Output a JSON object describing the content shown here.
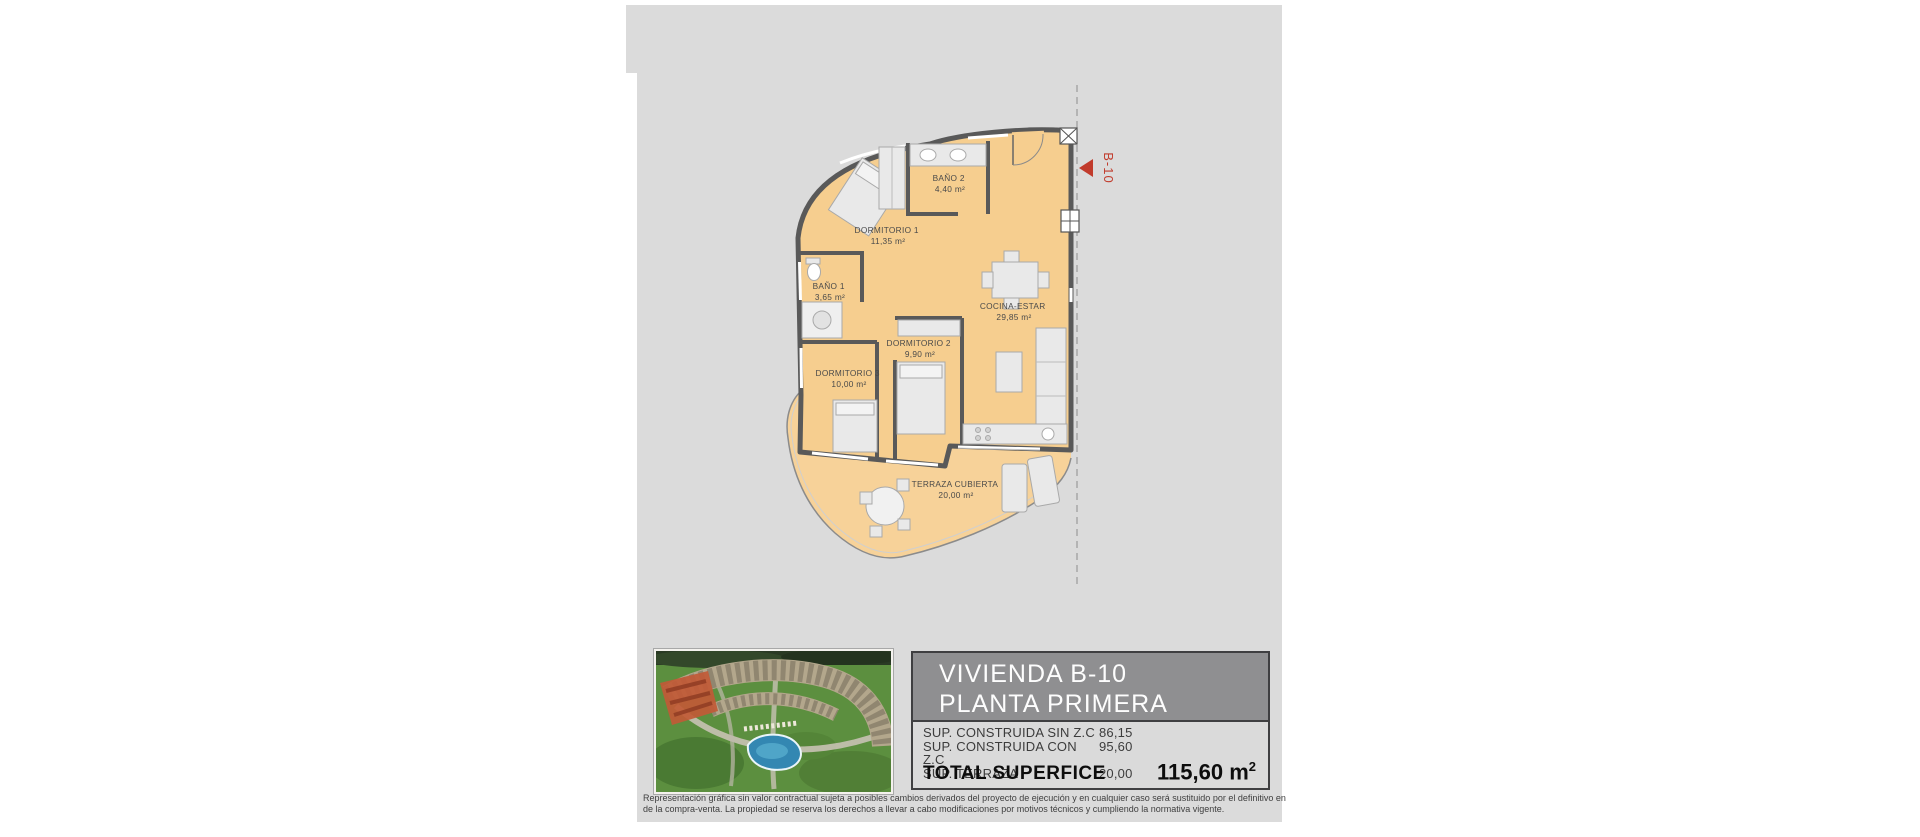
{
  "plan": {
    "marker_label": "B-10",
    "rooms": [
      {
        "name": "DORMITORIO 1",
        "area": "11,35 m²"
      },
      {
        "name": "BAÑO 2",
        "area": "4,40 m²"
      },
      {
        "name": "COCINA-ESTAR",
        "area": "29,85 m²"
      },
      {
        "name": "BAÑO 1",
        "area": "3,65 m²"
      },
      {
        "name": "DORMITORIO 2",
        "area": "9,90 m²"
      },
      {
        "name": "DORMITORIO 3",
        "area": "10,00 m²"
      },
      {
        "name": "TERRAZA CUBIERTA",
        "area": "20,00 m²"
      }
    ]
  },
  "info": {
    "title_line1": "VIVIENDA B-10",
    "title_line2": "PLANTA PRIMERA",
    "surfaces": [
      {
        "label": "SUP. CONSTRUIDA SIN Z.C",
        "value": "86,15"
      },
      {
        "label": "SUP. CONSTRUIDA CON Z.C",
        "value": "95,60"
      },
      {
        "label": "SUP. TERRAZA",
        "value": "20,00"
      }
    ],
    "total_label": "TOTAL SUPERFICE",
    "total_value": "115,60 m",
    "total_sup": "2"
  },
  "disclaimer": {
    "line1": "Representación gráfica sin valor contractual sujeta a posibles cambios derivados del proyecto de ejecución y en cualquier caso será sustituido por el definitivo en",
    "line2": "de la compra-venta. La propiedad se reserva los derechos a llevar a cabo modificaciones por motivos técnicos y cumpliendo la normativa vigente."
  },
  "colors": {
    "page_bg": "#DBDBDB",
    "plan_room_fill": "#F6CE8F",
    "plan_terrace_fill": "#F7D299",
    "wall": "#595959",
    "marker_red": "#C13B2C",
    "header_bg": "#8F8F91",
    "header_text": "#FDFDFD",
    "photo_pool": "#3387B2",
    "photo_highlight": "#C15A36"
  }
}
